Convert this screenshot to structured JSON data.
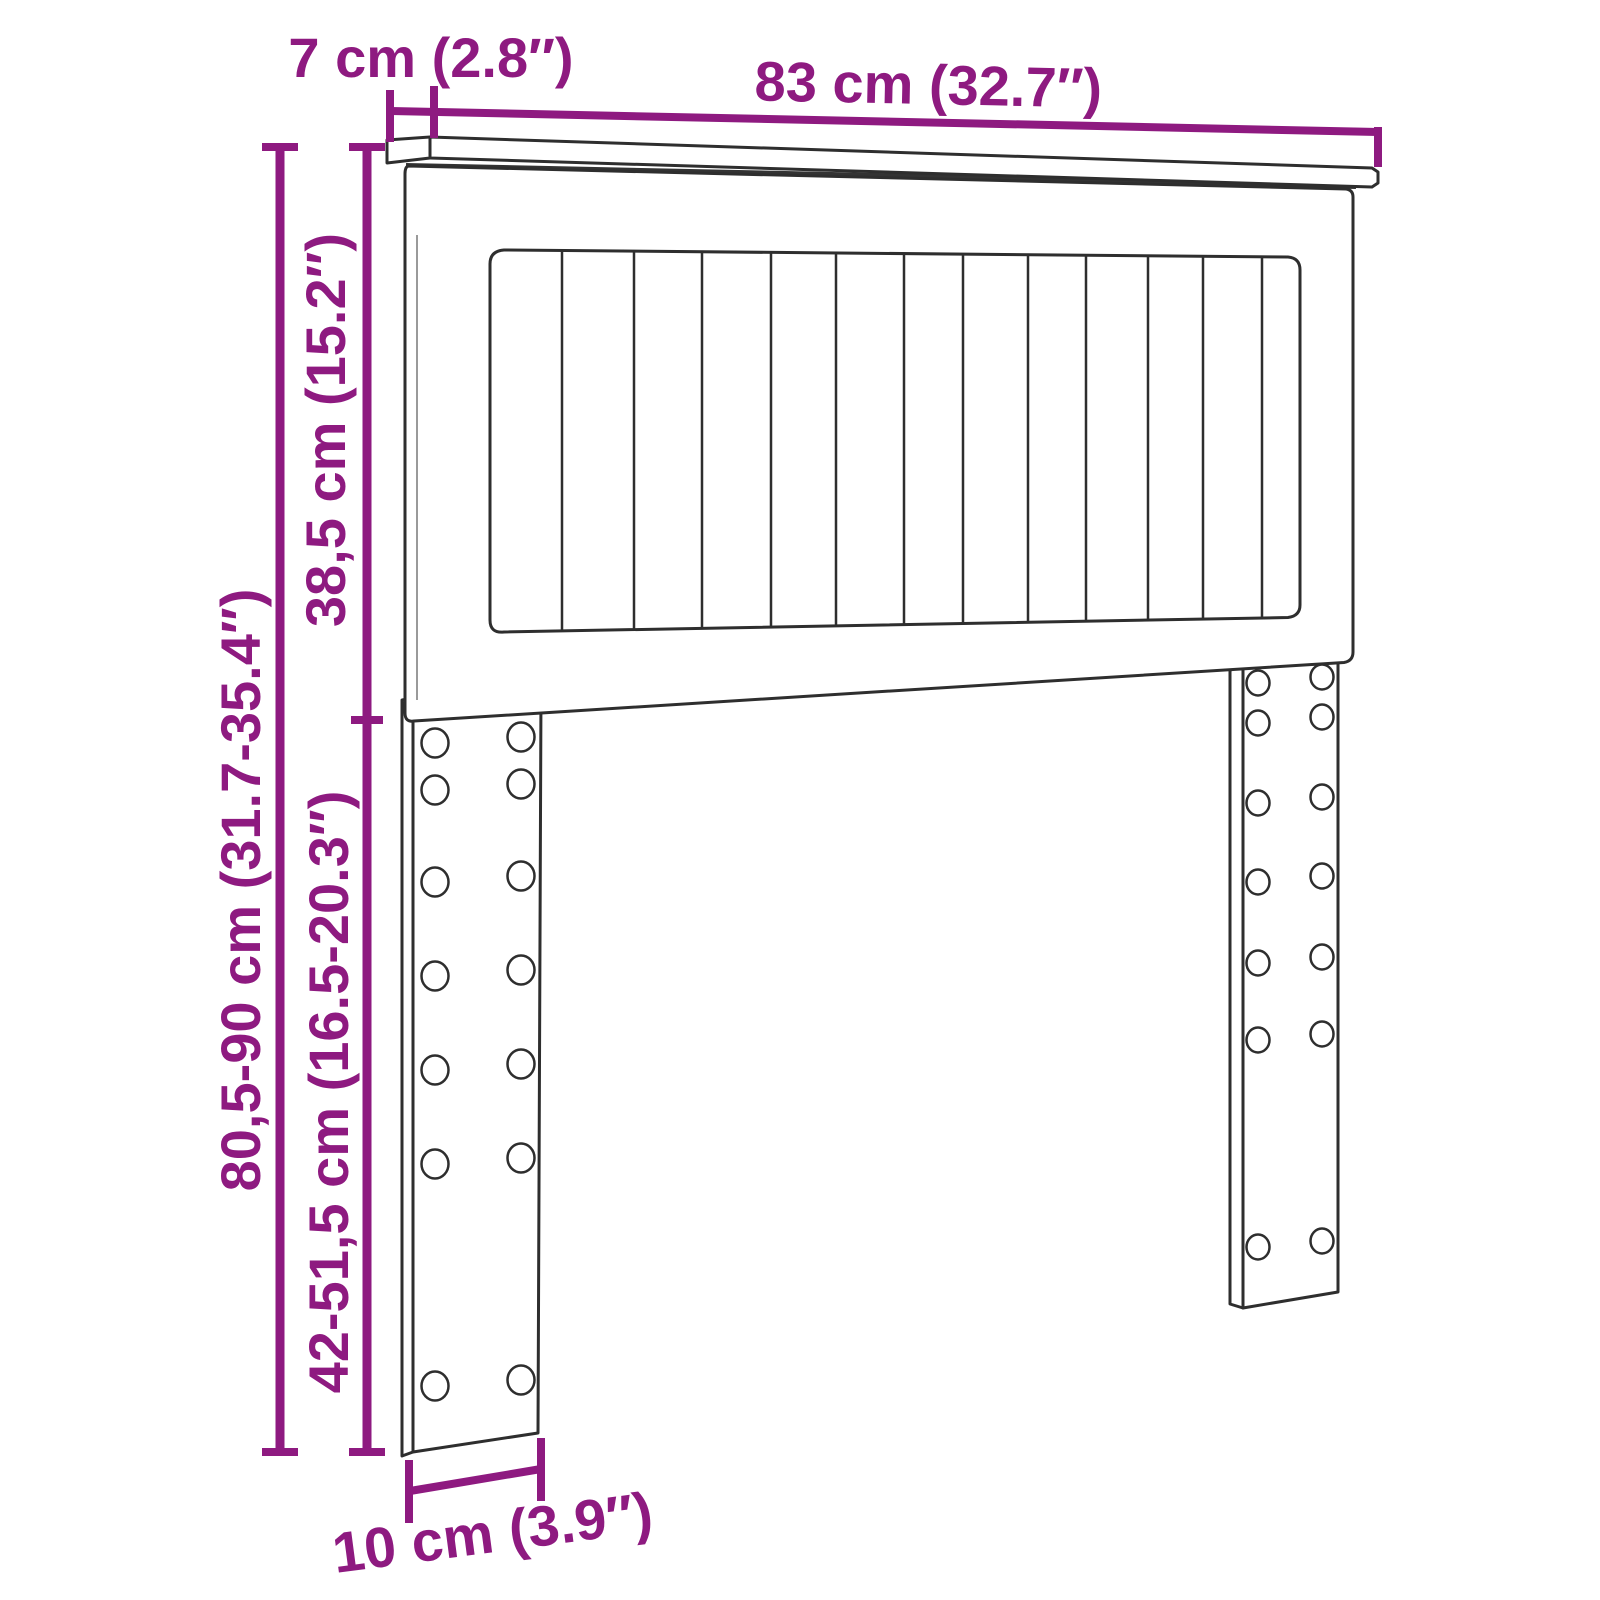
{
  "diagram": {
    "type": "furniture-dimension-diagram",
    "product": "headboard-with-slatted-panel-and-adjustable-legs",
    "accent_color": "#8E1A80",
    "line_color": "#2E2E2E",
    "shadow_color": "#333333",
    "background": "#FFFFFF"
  },
  "labels": {
    "board_depth": "7 cm (2.8″)",
    "overall_width": "83 cm (32.7″)",
    "panel_height": "38,5 cm (15.2″)",
    "overall_height": "80,5-90 cm (31.7-35.4″)",
    "leg_height": "42-51,5 cm (16.5-20.3″)",
    "foot_width": "10 cm (3.9″)"
  },
  "structure": {
    "slat_count": 13,
    "leg_count": 2,
    "hole_columns_per_leg": 2,
    "hole_rows_per_leg": 7
  }
}
